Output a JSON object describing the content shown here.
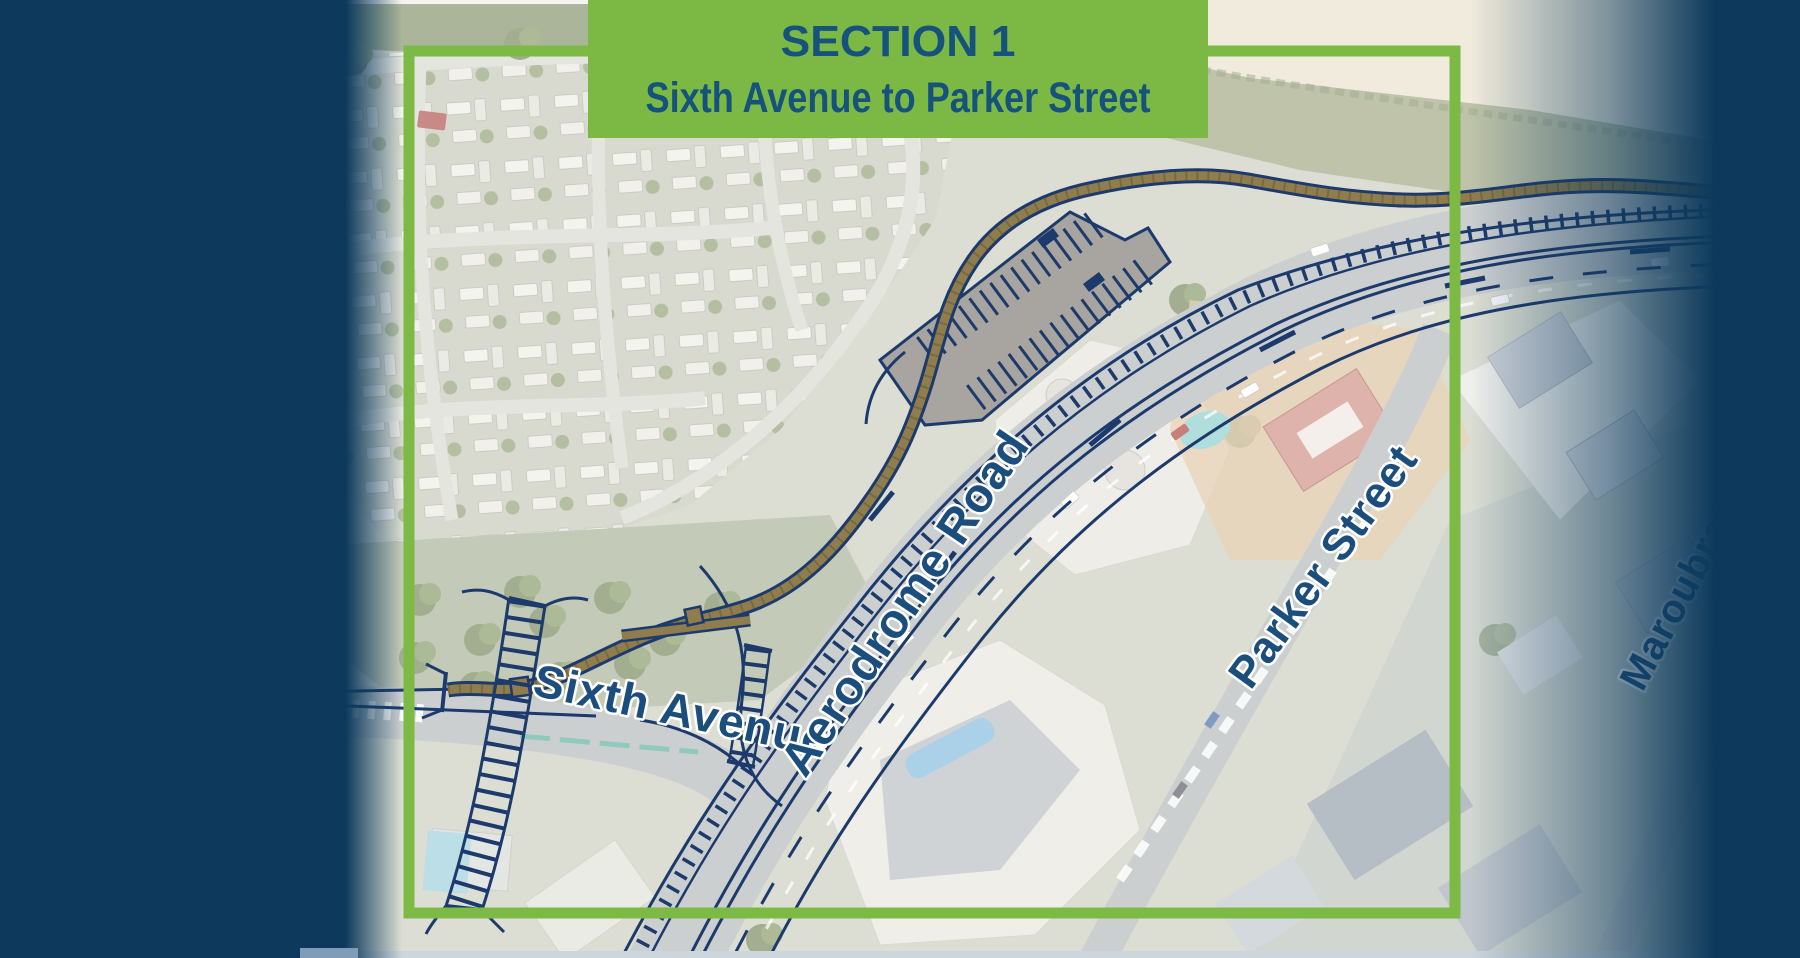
{
  "banner": {
    "title": "SECTION 1",
    "subtitle": "Sixth Avenue to Parker Street"
  },
  "labels": {
    "aerodrome_road": "Aerodrome Road",
    "parker_street": "Parker Street",
    "sixth_avenue": "Sixth Avenue",
    "maroubra_street": "Maroubra St"
  },
  "colors": {
    "banner_green": "#7cb944",
    "boundary_green": "#7dba45",
    "navy_band": "#0d3a5c",
    "label_navy": "#1c4e7d",
    "banner_text": "#15537c",
    "overlay_navy": "#1c3a6b",
    "path_tan": "#8f7d4e"
  }
}
